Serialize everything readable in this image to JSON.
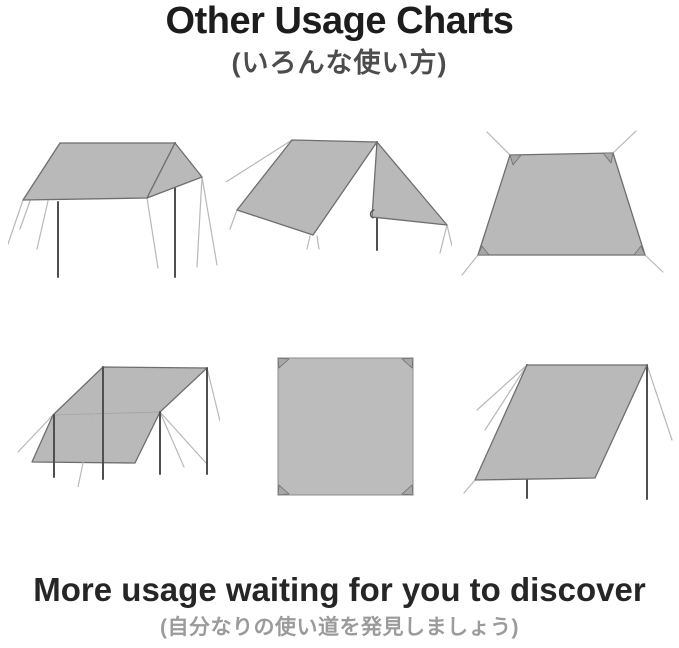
{
  "header": {
    "title": "Other Usage Charts",
    "subtitle": "(いろんな使い方)"
  },
  "footer": {
    "title": "More usage waiting for you to discover",
    "subtitle": "(自分なりの使い道を発見しましょう)"
  },
  "diagrams": [
    {
      "name": "flat-canopy-on-two-poles"
    },
    {
      "name": "a-frame-shelter-with-center-pole"
    },
    {
      "name": "staked-flat-ground-tarp"
    },
    {
      "name": "slanted-shelter-on-four-poles"
    },
    {
      "name": "flat-square-tarp-top-view"
    },
    {
      "name": "slanted-windbreak-on-two-poles"
    }
  ],
  "colors": {
    "background": "#ffffff",
    "title_text": "#1d1d1d",
    "subtitle_text": "#4c4c4c",
    "footer_title_text": "#262626",
    "footer_subtitle_text": "#9b9b9b",
    "tarp_fill": "#b9b9b9",
    "tarp_stroke": "#6e6e6e",
    "pole": "#4f4f4f",
    "guyline": "#b8b8b8"
  }
}
